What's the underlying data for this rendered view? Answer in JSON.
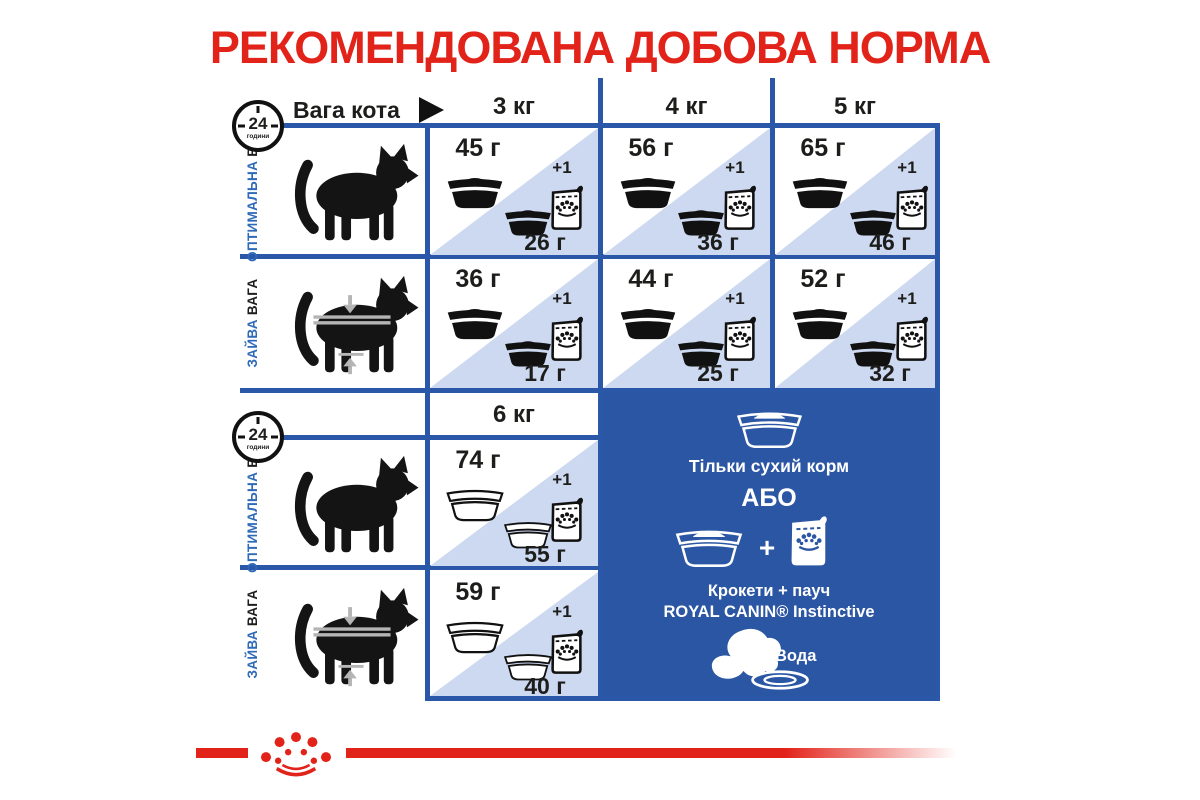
{
  "title": "РЕКОМЕНДОВАНА ДОБОВА НОРМА",
  "header": {
    "weight_label": "Вага кота",
    "columns": [
      "3 кг",
      "4 кг",
      "5 кг"
    ],
    "extra_column": "6 кг"
  },
  "clock": {
    "hours": "24",
    "unit": "години"
  },
  "labels": {
    "optimal": [
      "ОПТИМАЛЬНА",
      "ВАГА"
    ],
    "overweight": [
      "ЗАЙВА",
      "ВАГА"
    ]
  },
  "plus_one": "+1",
  "cells": {
    "section1": {
      "optimal": [
        {
          "dry": "45 г",
          "mixed": "26 г"
        },
        {
          "dry": "56 г",
          "mixed": "36 г"
        },
        {
          "dry": "65 г",
          "mixed": "46 г"
        }
      ],
      "overweight": [
        {
          "dry": "36 г",
          "mixed": "17 г"
        },
        {
          "dry": "44 г",
          "mixed": "25 г"
        },
        {
          "dry": "52 г",
          "mixed": "32 г"
        }
      ]
    },
    "section2": {
      "optimal": {
        "dry": "74 г",
        "mixed": "55 г"
      },
      "overweight": {
        "dry": "59 г",
        "mixed": "40 г"
      }
    }
  },
  "panel": {
    "dry_only": "Тільки сухий корм",
    "or": "АБО",
    "plus": "+",
    "mixed_line1": "Крокети + пауч",
    "mixed_line2": "ROYAL CANIN® Instinctive",
    "water": "Вода"
  },
  "icons": {
    "clock": "24-hour-clock",
    "arrow": "right-arrow",
    "bowl": "food-bowl",
    "pouch": "wet-food-pouch",
    "cat_optimal": "cat-silhouette",
    "cat_overweight": "cat-with-measuring-tape",
    "water": "water-splash",
    "brand": "royal-canin-crown"
  },
  "colors": {
    "red": "#e2231a",
    "line_blue": "#2b57a8",
    "panel_blue": "#2b56a4",
    "light_blue": "#ccd9f0",
    "label_blue": "#2e6ab8"
  }
}
